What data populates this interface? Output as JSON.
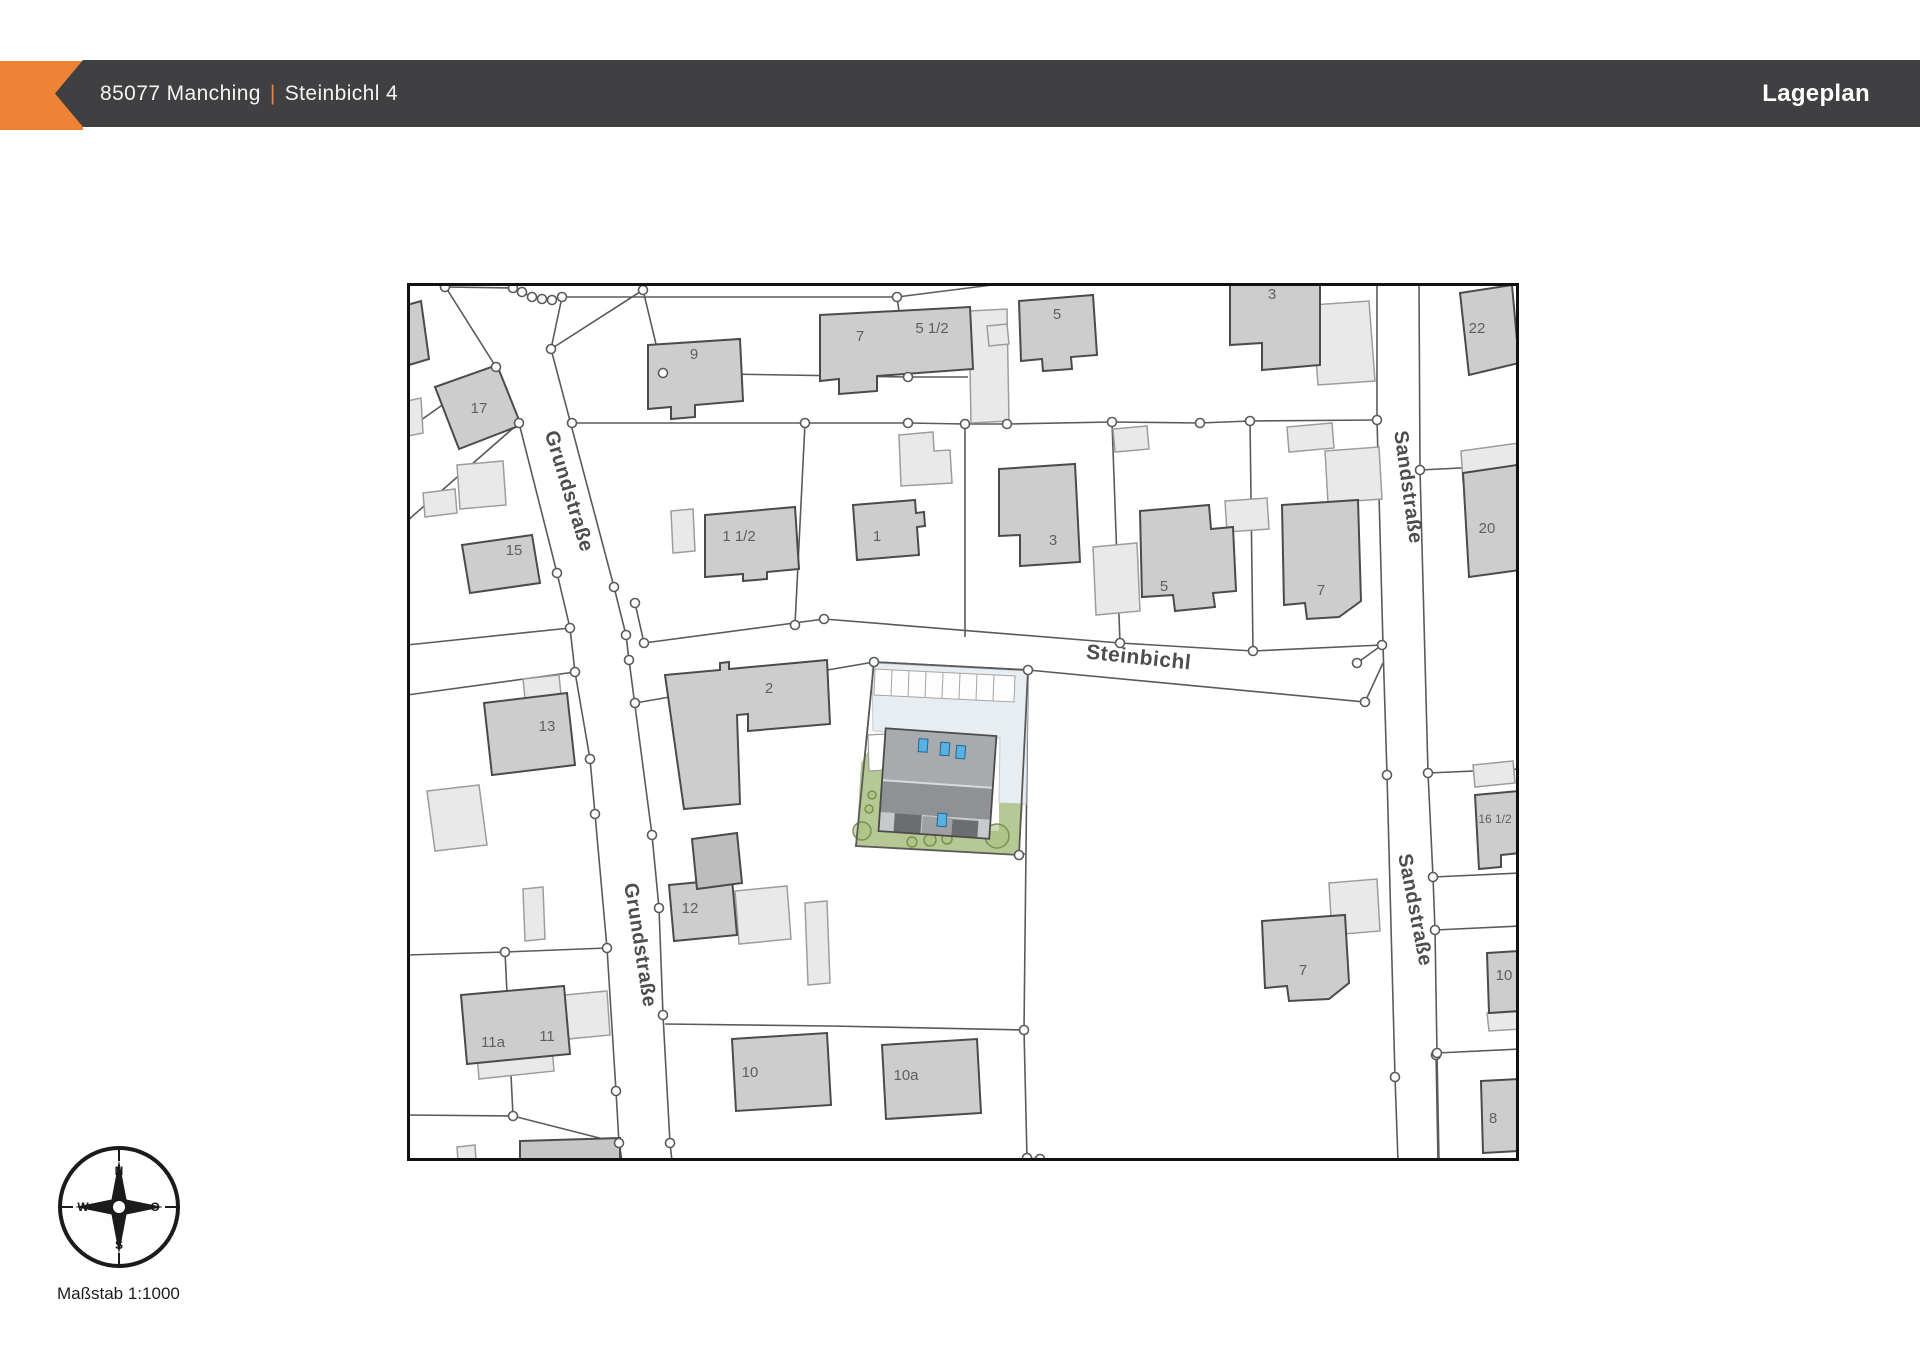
{
  "header": {
    "plz_city": "85077 Manching",
    "separator": "|",
    "street": "Steinbichl 4",
    "right_title": "Lageplan",
    "bar_color": "#403F41",
    "accent_color": "#EF8335",
    "text_color": "#F4F4F4"
  },
  "scale_text": "Maßstab 1:1000",
  "compass": {
    "north": "N",
    "east": "O",
    "south": "S",
    "west": "W"
  },
  "map": {
    "width": 1112,
    "height": 878,
    "colors": {
      "frame": "#111111",
      "line": "#5a5a5a",
      "building": "#cdcdcd",
      "building_stroke": "#4b4b4b",
      "building_dark": "#bdbdbd",
      "outbuilding": "#e9e9e9",
      "outbuilding_stroke": "#9d9d9d",
      "label": "#5f5f5f",
      "street_label": "#4d4d4d",
      "paving": "#e8edf1",
      "paving_stroke": "#c2cad0",
      "garden": "#b6c893",
      "tree_fill": "#aec181",
      "tree_stroke": "#7d9053",
      "roof_upper": "#a8abae",
      "roof_lower": "#8f9194",
      "roof_eaves": "#c7c9cb",
      "roof_mid": "#9ea0a3",
      "roof_dark": "#6b6d70",
      "ridge": "#d8d9da",
      "skylight": "#57b2e4",
      "skylight_stroke": "#29638c",
      "stall": "#fdfdfd",
      "stall_stroke": "#a5a5a5"
    },
    "street_labels": [
      {
        "text": "Grundstraße",
        "x": 156,
        "y": 210,
        "rotation": 73,
        "size": 20
      },
      {
        "text": "Grundstraße",
        "x": 227,
        "y": 663,
        "rotation": 81,
        "size": 20
      },
      {
        "text": "Steinbichl",
        "x": 731,
        "y": 381,
        "rotation": 6,
        "size": 21
      },
      {
        "text": "Sandstraße",
        "x": 995,
        "y": 205,
        "rotation": 82,
        "size": 20
      },
      {
        "text": "Sandstraße",
        "x": 1002,
        "y": 628,
        "rotation": 79,
        "size": 20
      }
    ],
    "parcel_lines": [
      "36,0 89,84 112,140 150,290 163,345 168,389 183,476 188,531 200,665 209,808 212,860 215,878",
      "155,14 144,66 207,304 219,352 222,377 245,552 252,625 256,732 263,860 265,878",
      "144,66 236,7",
      "38,4 106,5 115,9 125,14 135,16 145,17 155,14",
      "236,7 256,90 501,94 561,94",
      "490,14 501,94",
      "155,14 490,14 585,2",
      "165,140 398,140 501,140 558,141 600,141 705,139 793,140 843,138 970,137",
      "970,0 970,137 976,362 980,492 988,794 991,878",
      "1012,0 1013,187 1021,490 1026,594 1028,647 1030,770 1032,878",
      "1013,187 1113,182",
      "1021,490 1113,486",
      "1026,594 1113,590",
      "1028,647 1113,643",
      "1030,770 1113,766",
      "237,360 417,336 713,360 846,368 975,362",
      "228,320 237,360",
      "950,380 975,362",
      "228,420 467,379 621,387 958,419 976,380",
      "558,141 558,354",
      "705,139 713,360",
      "843,138 846,368",
      "398,140 388,342",
      "467,379 449,563 618,571",
      "621,387 617,747 620,875",
      "258,741 423,743 617,747",
      "620,875 633,876",
      "1029,770 1031,878",
      "0,147 89,84",
      "0,238 112,140",
      "0,362 163,345",
      "0,412 168,389",
      "0,672 98,669 200,665",
      "0,832 106,833 212,860",
      "98,669 106,833"
    ],
    "boundary_points": [
      [
        38,
        4
      ],
      [
        106,
        5
      ],
      [
        115,
        9
      ],
      [
        125,
        14
      ],
      [
        135,
        16
      ],
      [
        145,
        17
      ],
      [
        155,
        14
      ],
      [
        236,
        7
      ],
      [
        144,
        66
      ],
      [
        89,
        84
      ],
      [
        256,
        90
      ],
      [
        490,
        14
      ],
      [
        501,
        94
      ],
      [
        112,
        140
      ],
      [
        150,
        290
      ],
      [
        163,
        345
      ],
      [
        168,
        389
      ],
      [
        183,
        476
      ],
      [
        188,
        531
      ],
      [
        200,
        665
      ],
      [
        209,
        808
      ],
      [
        212,
        860
      ],
      [
        207,
        304
      ],
      [
        219,
        352
      ],
      [
        222,
        377
      ],
      [
        245,
        552
      ],
      [
        252,
        625
      ],
      [
        256,
        732
      ],
      [
        263,
        860
      ],
      [
        228,
        320
      ],
      [
        237,
        360
      ],
      [
        417,
        336
      ],
      [
        713,
        360
      ],
      [
        846,
        368
      ],
      [
        975,
        362
      ],
      [
        950,
        380
      ],
      [
        467,
        379
      ],
      [
        621,
        387
      ],
      [
        958,
        419
      ],
      [
        612,
        572
      ],
      [
        617,
        747
      ],
      [
        620,
        875
      ],
      [
        633,
        876
      ],
      [
        1029,
        772
      ],
      [
        398,
        140
      ],
      [
        501,
        140
      ],
      [
        558,
        141
      ],
      [
        600,
        141
      ],
      [
        705,
        139
      ],
      [
        793,
        140
      ],
      [
        843,
        138
      ],
      [
        970,
        137
      ],
      [
        980,
        492
      ],
      [
        988,
        794
      ],
      [
        1013,
        187
      ],
      [
        1021,
        490
      ],
      [
        1026,
        594
      ],
      [
        1028,
        647
      ],
      [
        1030,
        770
      ],
      [
        98,
        669
      ],
      [
        106,
        833
      ],
      [
        388,
        342
      ],
      [
        165,
        140
      ],
      [
        228,
        420
      ]
    ],
    "outbuildings": [
      "50,182 96,178 99,222 53,226",
      "16,210 48,206 50,230 18,234",
      "20,508 72,502 80,562 28,568",
      "116,396 152,392 154,412 118,416",
      "116,606 136,604 138,656 118,658",
      "158,712 200,708 203,752 161,756",
      "264,228 286,226 288,268 266,270",
      "492,152 526,149 527,168 543,167 545,200 494,203",
      "562,28 600,26 602,138 564,140",
      "518,36 539,34 541,52 520,54",
      "580,43 600,41 602,61 582,63",
      "905,22 962,18 968,98 911,102",
      "706,146 740,143 742,166 708,169",
      "880,144 925,140 927,165 882,169",
      "918,168 972,164 975,216 921,220",
      "818,218 860,215 862,246 820,249",
      "686,264 730,260 733,328 689,332",
      "1054,168 1112,160 1113,192 1056,198",
      "1066,482 1106,478 1108,500 1068,504",
      "1080,730 1112,728 1113,746 1082,748",
      "922,600 970,596 973,648 925,652",
      "328,608 380,603 384,656 332,661",
      "398,620 420,618 423,700 401,702",
      "50,864 68,862 69,878 51,878",
      "0,118 14,115 16,150 1,153",
      "70,772 145,764 147,788 72,796"
    ],
    "buildings": [
      {
        "points": "28,104 90,82 114,142 52,166",
        "labels": [
          {
            "t": "17",
            "x": 72,
            "y": 130
          }
        ]
      },
      {
        "points": "241,62 333,56 336,118 288,122 288,134 264,136 264,124 241,126",
        "labels": [
          {
            "t": "9",
            "x": 287,
            "y": 76
          }
        ]
      },
      {
        "points": "413,32 563,24 566,86 470,93 470,108 432,111 432,96 413,98",
        "labels": [
          {
            "t": "7",
            "x": 453,
            "y": 58
          },
          {
            "t": "5 1/2",
            "x": 525,
            "y": 50
          }
        ]
      },
      {
        "points": "612,18 686,12 690,72 664,74 665,86 636,88 635,76 614,78",
        "labels": [
          {
            "t": "5",
            "x": 650,
            "y": 36
          }
        ]
      },
      {
        "points": "823,0 913,0 913,82 855,87 855,60 823,62",
        "labels": [
          {
            "t": "3",
            "x": 865,
            "y": 16
          }
        ]
      },
      {
        "points": "1053,10 1105,2 1112,80 1062,92",
        "labels": [
          {
            "t": "22",
            "x": 1070,
            "y": 50
          }
        ]
      },
      {
        "points": "55,262 125,252 133,300 63,310",
        "labels": [
          {
            "t": "15",
            "x": 107,
            "y": 272
          }
        ]
      },
      {
        "points": "77,420 160,410 168,482 85,492",
        "labels": [
          {
            "t": "13",
            "x": 140,
            "y": 448
          }
        ]
      },
      {
        "points": "258,392 313,387 313,380 322,379 322,386 420,377 423,441 341,448 341,431 330,432 333,521 277,526",
        "labels": [
          {
            "t": "2",
            "x": 362,
            "y": 410
          }
        ]
      },
      {
        "points": "446,222 508,217 509,230 517,229 518,243 510,244 512,272 450,277",
        "labels": [
          {
            "t": "1",
            "x": 470,
            "y": 258
          }
        ]
      },
      {
        "points": "298,232 388,224 392,286 360,289 360,296 336,298 336,291 298,294",
        "labels": [
          {
            "t": "1 1/2",
            "x": 332,
            "y": 258
          }
        ]
      },
      {
        "points": "592,186 668,181 673,279 613,283 613,252 592,253",
        "labels": [
          {
            "t": "3",
            "x": 646,
            "y": 262
          }
        ]
      },
      {
        "points": "733,228 802,222 804,246 826,244 829,308 806,310 808,324 768,328 766,312 735,314",
        "labels": [
          {
            "t": "5",
            "x": 757,
            "y": 308
          }
        ]
      },
      {
        "points": "875,222 951,217 954,318 932,334 900,336 898,320 877,322",
        "labels": [
          {
            "t": "7",
            "x": 914,
            "y": 312
          }
        ]
      },
      {
        "points": "1056,190 1110,182 1113,287 1062,294",
        "labels": [
          {
            "t": "20",
            "x": 1080,
            "y": 250
          }
        ]
      },
      {
        "points": "1068,512 1112,508 1113,570 1094,572 1094,584 1072,586",
        "labels": [
          {
            "t": "16 1/2",
            "x": 1088,
            "y": 540,
            "fs": 12
          }
        ]
      },
      {
        "points": "1080,670 1112,668 1113,728 1082,730",
        "labels": [
          {
            "t": "10",
            "x": 1097,
            "y": 697
          }
        ]
      },
      {
        "points": "1074,798 1112,796 1113,868 1076,870",
        "labels": [
          {
            "t": "8",
            "x": 1086,
            "y": 840
          }
        ]
      },
      {
        "points": "855,638 938,632 942,700 922,716 882,718 880,703 858,705",
        "labels": [
          {
            "t": "7",
            "x": 896,
            "y": 692
          }
        ]
      },
      {
        "points": "262,602 325,596 330,652 267,658",
        "labels": [
          {
            "t": "12",
            "x": 283,
            "y": 630
          }
        ]
      },
      {
        "points": "285,556 330,550 335,600 290,606",
        "fill": "#bdbdbd",
        "labels": []
      },
      {
        "points": "325,756 420,750 424,822 329,828",
        "labels": [
          {
            "t": "10",
            "x": 343,
            "y": 794
          }
        ]
      },
      {
        "points": "475,762 570,756 574,830 479,836",
        "labels": [
          {
            "t": "10a",
            "x": 499,
            "y": 797
          }
        ]
      },
      {
        "points": "54,712 157,703 163,771 60,781",
        "labels": [
          {
            "t": "11a",
            "x": 86,
            "y": 764
          },
          {
            "t": "11",
            "x": 140,
            "y": 758
          }
        ]
      },
      {
        "points": "113,858 213,855 213,878 113,878",
        "fill": "#c6c6c6",
        "labels": []
      },
      {
        "points": "0,22 14,18 22,76 2,82",
        "labels": []
      }
    ],
    "subject": {
      "shapes": [
        {
          "kind": "polygon",
          "points": "465,380 621,388 619,521 592,520 593,455 466,448",
          "fill": "paving",
          "stroke": "paving_stroke",
          "sw": 1
        },
        {
          "kind": "polygon",
          "points": "466,460 477,460 477,543 592,548 592,520 616,521 612,572 449,563 454,480",
          "fill": "garden"
        },
        {
          "kind": "polygon",
          "points": "461,452 478,451 479,487 462,488",
          "fill": "#ffffff",
          "stroke": "outbuilding_stroke",
          "sw": 1.2
        },
        {
          "kind": "polygon",
          "points": "468,386 608,393 607,419 467,412",
          "fill": "stall",
          "stroke": "stall_stroke",
          "sw": 1
        },
        {
          "kind": "line",
          "x1": 485,
          "y1": 387,
          "x2": 484,
          "y2": 413,
          "stroke": "stall_stroke",
          "sw": 1
        },
        {
          "kind": "line",
          "x1": 502,
          "y1": 388,
          "x2": 501,
          "y2": 414,
          "stroke": "stall_stroke",
          "sw": 1
        },
        {
          "kind": "line",
          "x1": 519,
          "y1": 389,
          "x2": 518,
          "y2": 414,
          "stroke": "stall_stroke",
          "sw": 1
        },
        {
          "kind": "line",
          "x1": 536,
          "y1": 390,
          "x2": 535,
          "y2": 415,
          "stroke": "stall_stroke",
          "sw": 1
        },
        {
          "kind": "line",
          "x1": 553,
          "y1": 390,
          "x2": 552,
          "y2": 416,
          "stroke": "stall_stroke",
          "sw": 1
        },
        {
          "kind": "line",
          "x1": 570,
          "y1": 391,
          "x2": 569,
          "y2": 417,
          "stroke": "stall_stroke",
          "sw": 1
        },
        {
          "kind": "line",
          "x1": 587,
          "y1": 392,
          "x2": 586,
          "y2": 418,
          "stroke": "stall_stroke",
          "sw": 1
        },
        {
          "kind": "circle",
          "cx": 465,
          "cy": 512,
          "r": 4
        },
        {
          "kind": "circle",
          "cx": 462,
          "cy": 526,
          "r": 4
        },
        {
          "kind": "circle",
          "cx": 455,
          "cy": 548,
          "r": 9
        },
        {
          "kind": "circle",
          "cx": 505,
          "cy": 559,
          "r": 5
        },
        {
          "kind": "circle",
          "cx": 523,
          "cy": 557,
          "r": 6
        },
        {
          "kind": "circle",
          "cx": 540,
          "cy": 556,
          "r": 5
        },
        {
          "kind": "circle",
          "cx": 590,
          "cy": 553,
          "r": 12
        }
      ],
      "house": {
        "rotation": 4,
        "cx": 530,
        "cy": 500,
        "parts": [
          {
            "x": 475,
            "y": 449,
            "w": 111,
            "h": 52,
            "fill": "roof_upper"
          },
          {
            "x": 475,
            "y": 501,
            "w": 111,
            "h": 32,
            "fill": "roof_lower"
          },
          {
            "x": 475,
            "y": 533,
            "w": 111,
            "h": 19,
            "fill": "roof_eaves"
          },
          {
            "x": 518,
            "y": 534,
            "w": 30,
            "h": 18,
            "fill": "roof_mid"
          },
          {
            "x": 490,
            "y": 533,
            "w": 27,
            "h": 19,
            "fill": "roof_dark"
          },
          {
            "x": 548,
            "y": 535,
            "w": 26,
            "h": 17,
            "fill": "roof_dark"
          }
        ],
        "ridge": {
          "x1": 475,
          "y1": 501,
          "x2": 586,
          "y2": 501
        },
        "outline": {
          "x": 475,
          "y": 449,
          "w": 111,
          "h": 103
        },
        "skylights": [
          {
            "x": 509,
            "y": 457,
            "w": 9,
            "h": 13
          },
          {
            "x": 531,
            "y": 459,
            "w": 9,
            "h": 13
          },
          {
            "x": 547,
            "y": 461,
            "w": 9,
            "h": 13
          },
          {
            "x": 533,
            "y": 530,
            "w": 9,
            "h": 13
          }
        ]
      },
      "parcel_outline": "467,379 621,387 612,572 449,563"
    }
  }
}
